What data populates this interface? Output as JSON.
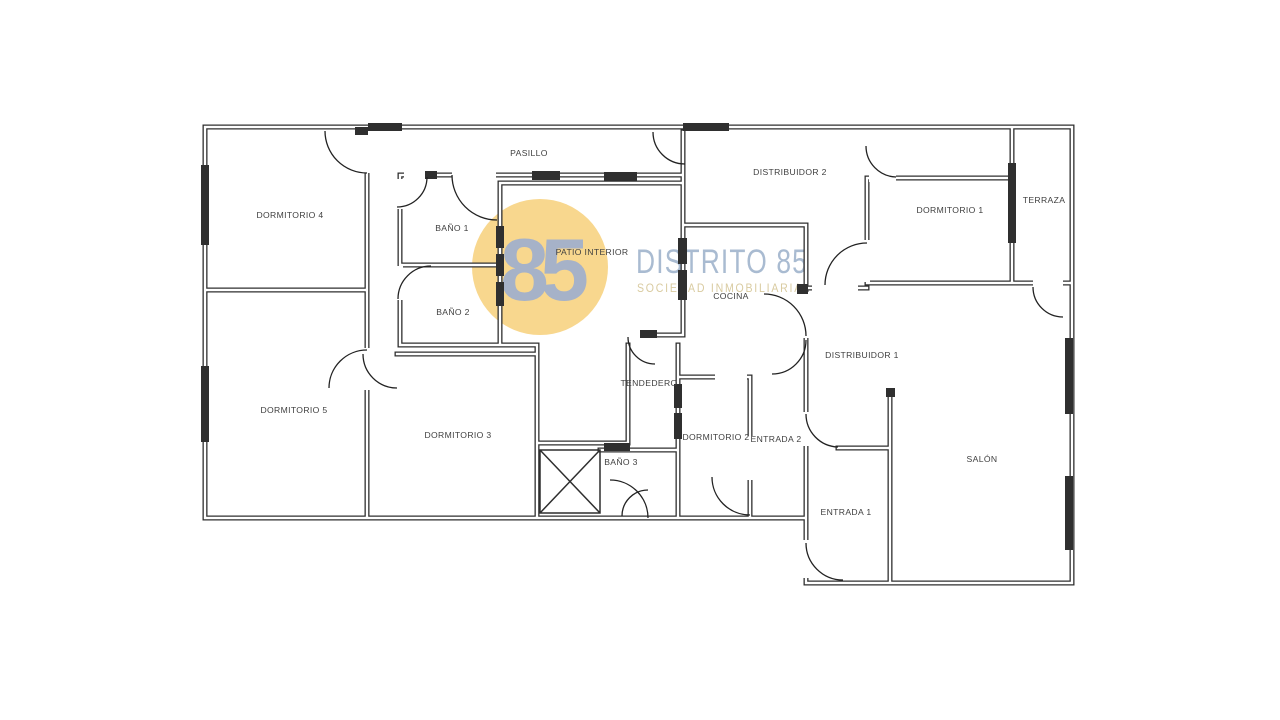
{
  "document": {
    "type": "residential floor plan"
  },
  "watermark": {
    "monogram": "85",
    "brand": "DISTRITO 85",
    "tagline": "SOCIEDAD INMOBILIARIA",
    "circle_color": "#F8D78E",
    "monogram_color": "#A6B2C8",
    "brand_color": "#A9BBD1",
    "tagline_color": "#D9CBA0"
  },
  "plan": {
    "wall_color": "#2F2F2F",
    "label_color": "#3F3F3F",
    "rooms": [
      {
        "id": "pasillo",
        "label": "PASILLO"
      },
      {
        "id": "dormitorio-4",
        "label": "DORMITORIO 4"
      },
      {
        "id": "bano-1",
        "label": "BAÑO 1"
      },
      {
        "id": "patio-interior",
        "label": "PATIO INTERIOR"
      },
      {
        "id": "distribuidor-2",
        "label": "DISTRIBUIDOR 2"
      },
      {
        "id": "dormitorio-1",
        "label": "DORMITORIO 1"
      },
      {
        "id": "terraza",
        "label": "TERRAZA"
      },
      {
        "id": "cocina",
        "label": "COCINA"
      },
      {
        "id": "bano-2",
        "label": "BAÑO 2"
      },
      {
        "id": "distribuidor-1",
        "label": "DISTRIBUIDOR 1"
      },
      {
        "id": "dormitorio-5",
        "label": "DORMITORIO 5"
      },
      {
        "id": "tendedero",
        "label": "TENDEDERO"
      },
      {
        "id": "dormitorio-3",
        "label": "DORMITORIO 3"
      },
      {
        "id": "dormitorio-2",
        "label": "DORMITORIO 2"
      },
      {
        "id": "entrada-2",
        "label": "ENTRADA 2"
      },
      {
        "id": "bano-3",
        "label": "BAÑO 3"
      },
      {
        "id": "entrada-1",
        "label": "ENTRADA 1"
      },
      {
        "id": "salon",
        "label": "SALÓN"
      }
    ]
  }
}
